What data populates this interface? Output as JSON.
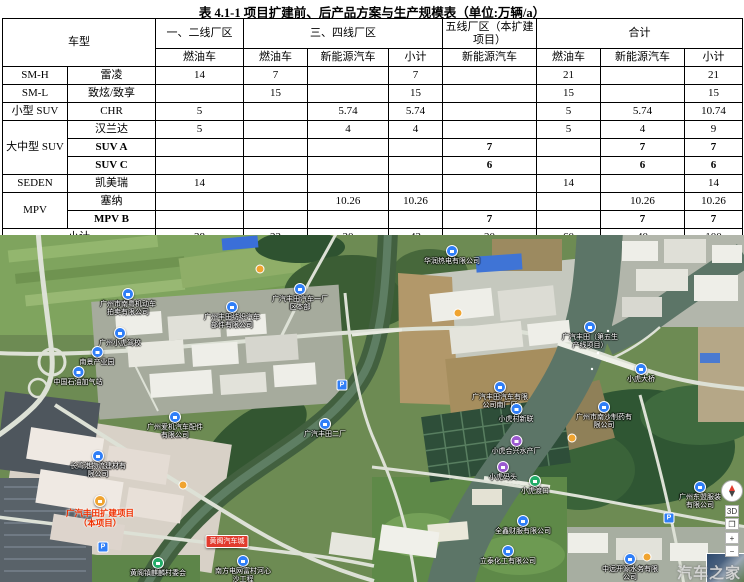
{
  "title": "表 4.1-1 项目扩建前、后产品方案与生产规模表（单位:万辆/a）",
  "table": {
    "header": {
      "vehicle_type": "车型",
      "g1": "一、二线厂区",
      "g2": "三、四线厂区",
      "g3": "五线厂区（本扩建项目）",
      "g4": "合计",
      "c1": "燃油车",
      "c2": "燃油车",
      "c3": "新能源汽车",
      "c4": "小计",
      "c5": "新能源汽车",
      "c6": "燃油车",
      "c7": "新能源汽车",
      "c8": "小计"
    },
    "rows": [
      {
        "cat": "SM-H",
        "catspan": 1,
        "model": "雷凌",
        "bold": false,
        "v": [
          "14",
          "7",
          "",
          "7",
          "",
          "21",
          "",
          "21"
        ]
      },
      {
        "cat": "SM-L",
        "catspan": 1,
        "model": "致炫/致享",
        "bold": false,
        "v": [
          "",
          "15",
          "",
          "15",
          "",
          "15",
          "",
          "15"
        ]
      },
      {
        "cat": "小型 SUV",
        "catspan": 1,
        "model": "CHR",
        "bold": false,
        "v": [
          "5",
          "",
          "5.74",
          "5.74",
          "",
          "5",
          "5.74",
          "10.74"
        ]
      },
      {
        "cat": "大中型 SUV",
        "catspan": 3,
        "model": "汉兰达",
        "bold": false,
        "v": [
          "5",
          "",
          "4",
          "4",
          "",
          "5",
          "4",
          "9"
        ]
      },
      {
        "cat": null,
        "model": "SUV A",
        "bold": true,
        "v": [
          "",
          "",
          "",
          "",
          "7",
          "",
          "7",
          "7"
        ]
      },
      {
        "cat": null,
        "model": "SUV C",
        "bold": true,
        "v": [
          "",
          "",
          "",
          "",
          "6",
          "",
          "6",
          "6"
        ]
      },
      {
        "cat": "SEDEN",
        "catspan": 1,
        "model": "凯美瑞",
        "bold": false,
        "v": [
          "14",
          "",
          "",
          "",
          "",
          "14",
          "",
          "14"
        ]
      },
      {
        "cat": "MPV",
        "catspan": 2,
        "model": "塞纳",
        "bold": false,
        "v": [
          "",
          "",
          "10.26",
          "10.26",
          "",
          "",
          "10.26",
          "10.26"
        ]
      },
      {
        "cat": null,
        "model": "MPV B",
        "bold": true,
        "v": [
          "",
          "",
          "",
          "",
          "7",
          "",
          "7",
          "7"
        ]
      }
    ],
    "footer": {
      "label": "小计",
      "values": [
        "38",
        "22",
        "20",
        "42",
        "20",
        "60",
        "40",
        "100"
      ]
    }
  },
  "map": {
    "labels": [
      {
        "text": "广州市南粤机动车拍卖有限公司",
        "x": 128,
        "y": 53,
        "pin": "blue"
      },
      {
        "text": "广州小虎驾校",
        "x": 120,
        "y": 92,
        "pin": "blue"
      },
      {
        "text": "南景产业园",
        "x": 97,
        "y": 111,
        "pin": "blue"
      },
      {
        "text": "中国石油加气站",
        "x": 78,
        "y": 131,
        "pin": "blue"
      },
      {
        "text": "广州丰田纺织汽车部件有限公司",
        "x": 232,
        "y": 66,
        "pin": "blue"
      },
      {
        "text": "广汽丰田汽车一厂区本部",
        "x": 300,
        "y": 48,
        "pin": "blue"
      },
      {
        "text": "华润热电有限公司",
        "x": 452,
        "y": 10,
        "pin": "blue"
      },
      {
        "text": "广汽丰田（第五生产线项目）",
        "x": 590,
        "y": 86,
        "pin": "blue"
      },
      {
        "text": "小虎大桥",
        "x": 641,
        "y": 128,
        "pin": "blue"
      },
      {
        "text": "广汽丰田汽车有限公司南厂区",
        "x": 500,
        "y": 146,
        "pin": "blue"
      },
      {
        "text": "广州爱机汽车配件有限公司",
        "x": 175,
        "y": 176,
        "pin": "blue"
      },
      {
        "text": "广汽丰田二厂",
        "x": 325,
        "y": 183,
        "pin": "blue"
      },
      {
        "text": "小虎村新联",
        "x": 516,
        "y": 168,
        "pin": "blue"
      },
      {
        "text": "广州市南沙制药有限公司",
        "x": 604,
        "y": 166,
        "pin": "blue"
      },
      {
        "text": "小虎合兴水产厂",
        "x": 516,
        "y": 200,
        "pin": "purple"
      },
      {
        "text": "小虎码头",
        "x": 503,
        "y": 226,
        "pin": "purple"
      },
      {
        "text": "小虎渡口",
        "x": 535,
        "y": 240,
        "pin": "green"
      },
      {
        "text": "广汽丰田扩建项目（本项目）",
        "x": 100,
        "y": 260,
        "pin": "orange",
        "style": "red"
      },
      {
        "text": "黄阁汽车城",
        "x": 227,
        "y": 300,
        "pin": "red-badge"
      },
      {
        "text": "黄阁镇麒麟村委会",
        "x": 158,
        "y": 322,
        "pin": "green"
      },
      {
        "text": "南方电网富村河心沙工程",
        "x": 243,
        "y": 320,
        "pin": "blue"
      },
      {
        "text": "长湾港物流建材有限公司",
        "x": 98,
        "y": 215,
        "pin": "blue"
      },
      {
        "text": "全鑫财服有限公司",
        "x": 523,
        "y": 280,
        "pin": "blue"
      },
      {
        "text": "立泰化工有限公司",
        "x": 508,
        "y": 310,
        "pin": "blue"
      },
      {
        "text": "广州东盟服装有限公司",
        "x": 700,
        "y": 246,
        "pin": "blue"
      },
      {
        "text": "中远开源水务有限公司",
        "x": 630,
        "y": 318,
        "pin": "blue"
      }
    ],
    "parking_icons": [
      {
        "x": 342,
        "y": 150
      },
      {
        "x": 103,
        "y": 312
      },
      {
        "x": 669,
        "y": 283
      }
    ],
    "poi_icons": [
      {
        "x": 458,
        "y": 78
      },
      {
        "x": 572,
        "y": 203
      },
      {
        "x": 647,
        "y": 322
      },
      {
        "x": 183,
        "y": 250
      },
      {
        "x": 260,
        "y": 34
      }
    ],
    "parking_glyph": "P",
    "controls": {
      "three_d": "3D",
      "layers_glyph": "❐",
      "zoom_in": "+",
      "zoom_out": "−"
    },
    "watermark": "汽车之家",
    "colors": {
      "pin_blue": "#2f7ef7",
      "pin_purple": "#9b59d0",
      "pin_green": "#22ab67",
      "pin_orange": "#f0a430",
      "project_red": "#f03000",
      "badge_red": "#e23b2e"
    }
  }
}
